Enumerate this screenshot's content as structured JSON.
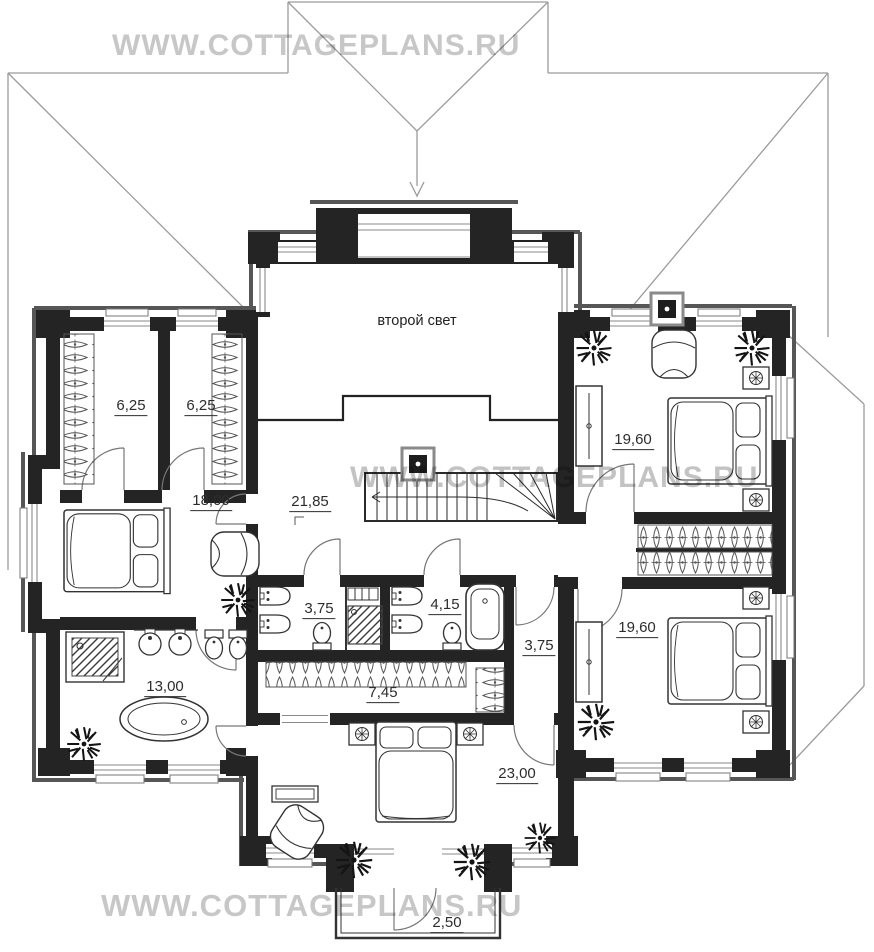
{
  "watermarks": [
    {
      "id": "top",
      "text": "WWW.COTTAGEPLANS.RU"
    },
    {
      "id": "middle",
      "text": "WWW.COTTAGEPLANS.RU"
    },
    {
      "id": "bottom",
      "text": "WWW.COTTAGEPLANS.RU"
    }
  ],
  "plan": {
    "open_space_label": "второй свет",
    "rooms": [
      {
        "name": "wardrobe-left",
        "area": "6,25"
      },
      {
        "name": "wardrobe-right",
        "area": "6,25"
      },
      {
        "name": "bedroom-left",
        "area": "18,00"
      },
      {
        "name": "hall-stairs",
        "area": "21,85"
      },
      {
        "name": "bedroom-top-right",
        "area": "19,60"
      },
      {
        "name": "bathroom-master",
        "area": "13,00"
      },
      {
        "name": "bathroom-center",
        "area": "3,75"
      },
      {
        "name": "bathroom-right",
        "area": "4,15"
      },
      {
        "name": "corridor",
        "area": "3,75"
      },
      {
        "name": "wardrobe-center",
        "area": "7,45"
      },
      {
        "name": "bedroom-bottom-right",
        "area": "19,60"
      },
      {
        "name": "bedroom-bottom",
        "area": "23,00"
      },
      {
        "name": "balcony",
        "area": "2,50"
      }
    ]
  },
  "colors": {
    "wall": "#242424",
    "roof_line": "#9b9b9b",
    "exterior_shadow": "#565656",
    "watermark": "#c7c7c7",
    "label_text": "#2d2d2d"
  }
}
